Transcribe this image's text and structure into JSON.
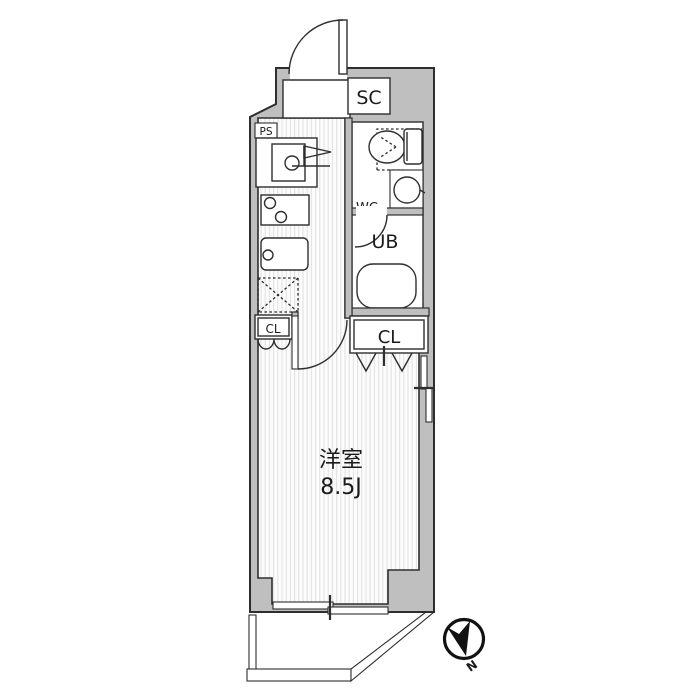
{
  "floorplan": {
    "labels": {
      "pipe_space": "PS",
      "shoe_closet": "SC",
      "toilet": "WC",
      "unit_bath": "UB",
      "closet_kitchen": "CL",
      "closet_room": "CL",
      "room_name": "洋室",
      "room_size": "8.5J",
      "compass_north": "N"
    },
    "colors": {
      "wall_fill": "#bfbfbf",
      "outline": "#2e2e2e",
      "floor_stripe": "#e4e4e4",
      "background": "#ffffff"
    }
  }
}
